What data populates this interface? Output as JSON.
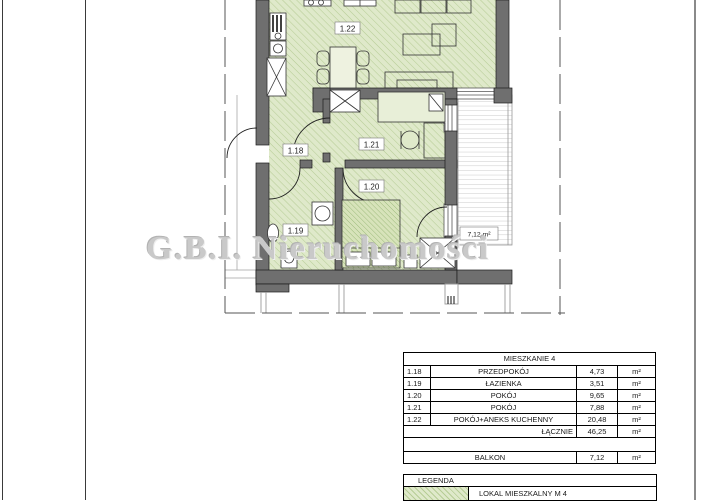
{
  "watermark": "G.B.I. Nieruchomości",
  "plan": {
    "rooms": [
      {
        "id": "1.18",
        "name": "PRZEDPOKÓJ"
      },
      {
        "id": "1.19",
        "name": "ŁAZIENKA"
      },
      {
        "id": "1.20",
        "name": "POKÓJ"
      },
      {
        "id": "1.21",
        "name": "POKÓJ"
      },
      {
        "id": "1.22",
        "name": "POKÓJ+ANEKS KUCHENNY"
      }
    ],
    "balcony_area_label": "7,12 m²"
  },
  "area_table": {
    "title": "MIESZKANIE 4",
    "rows": [
      {
        "no": "1.18",
        "name": "PRZEDPOKÓJ",
        "value": "4,73",
        "unit": "m²"
      },
      {
        "no": "1.19",
        "name": "ŁAZIENKA",
        "value": "3,51",
        "unit": "m²"
      },
      {
        "no": "1.20",
        "name": "POKÓJ",
        "value": "9,65",
        "unit": "m²"
      },
      {
        "no": "1.21",
        "name": "POKÓJ",
        "value": "7,88",
        "unit": "m²"
      },
      {
        "no": "1.22",
        "name": "POKÓJ+ANEKS KUCHENNY",
        "value": "20,48",
        "unit": "m²"
      }
    ],
    "total_label": "ŁĄCZNIE",
    "total_value": "46,25",
    "total_unit": "m²",
    "balcony_label": "BALKON",
    "balcony_value": "7,12",
    "balcony_unit": "m²"
  },
  "legend": {
    "title": "LEGENDA",
    "items": [
      {
        "label": "LOKAL MIESZKALNY M 4"
      }
    ]
  },
  "colors": {
    "floor_green": "#dfe9ca",
    "hatch_green": "#b7cd96",
    "wall_gray": "#6f6f6f",
    "watermark_gray": "#c9c9c9"
  }
}
